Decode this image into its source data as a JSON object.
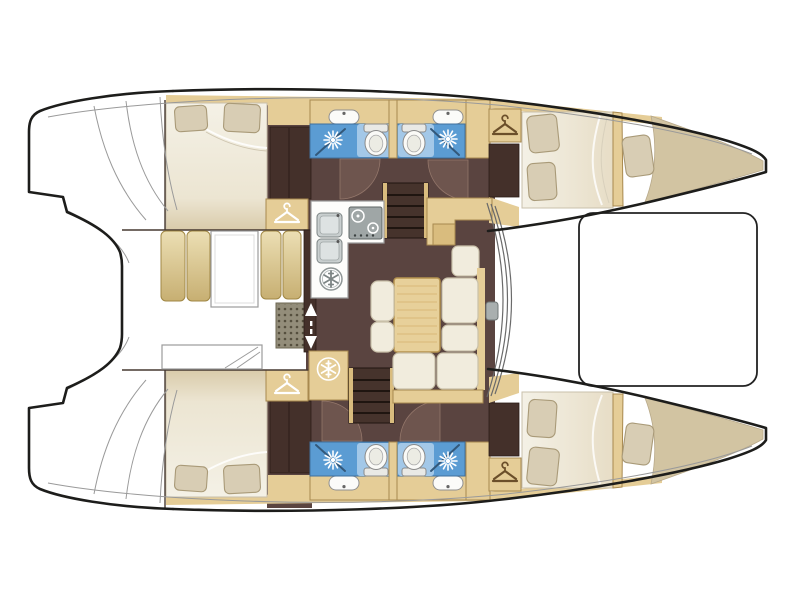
{
  "document": {
    "title": "Catamaran interior layout floor plan (top view)",
    "canvas": {
      "width": 800,
      "height": 600
    }
  },
  "palette": {
    "background": "#ffffff",
    "outline": "#1d1d1b",
    "line_soft": "#9a9a9a",
    "wood": "#e5cd97",
    "wood_mid": "#d9bc7e",
    "wood_border": "#a8894f",
    "bow_deck": "#d2c4a2",
    "floor_dark": "#5a4440",
    "floor_door": "#6e554e",
    "cabinet_dark": "#44302a",
    "bed_cream": "#f2eee2",
    "bed_shade": "#ddd2b8",
    "pillow": "#d8cdb4",
    "pillow_border": "#a99a78",
    "sofa_cream": "#f1ecdd",
    "sofa_border": "#c9c0a9",
    "bath_blue": "#5b9cd3",
    "bath_blue_light": "#a3c8e8",
    "glass_line": "#33587a",
    "appliance_gray": "#9fa6a6",
    "steel_light": "#c9cfcf",
    "grate_bg": "#938d7a",
    "grate_dot": "#554f3e",
    "table_wood": "#e7d09a",
    "icon_dark": "#6b4f2a",
    "icon_white": "#ffffff"
  },
  "features": {
    "vessel_type": "catamaran",
    "hulls": 2,
    "double_cabins": 4,
    "forepeak_berths": 2,
    "bathrooms": 4,
    "showers": 4,
    "toilets": 4,
    "washbasins": 4,
    "saloon_items": [
      "galley-counter",
      "stove",
      "double-sink",
      "fridge",
      "freezer",
      "dining-table",
      "chairs",
      "l-shaped-sofa",
      "nav-seat",
      "companionway-steps"
    ],
    "cockpit_items": [
      "bench-cushions",
      "cockpit-table",
      "deck-grate",
      "helm-bench",
      "sliding-door"
    ],
    "deck_items": [
      "trampoline",
      "mast-step",
      "windshield",
      "stern-swim-platforms"
    ],
    "icons": {
      "wardrobe": "hanger-icon",
      "fridge_freezer": "snowflake-icon",
      "shower": "spray-burst-icon",
      "door": "quarter-circle-swing",
      "sliding_door": "up-down-arrows"
    }
  }
}
